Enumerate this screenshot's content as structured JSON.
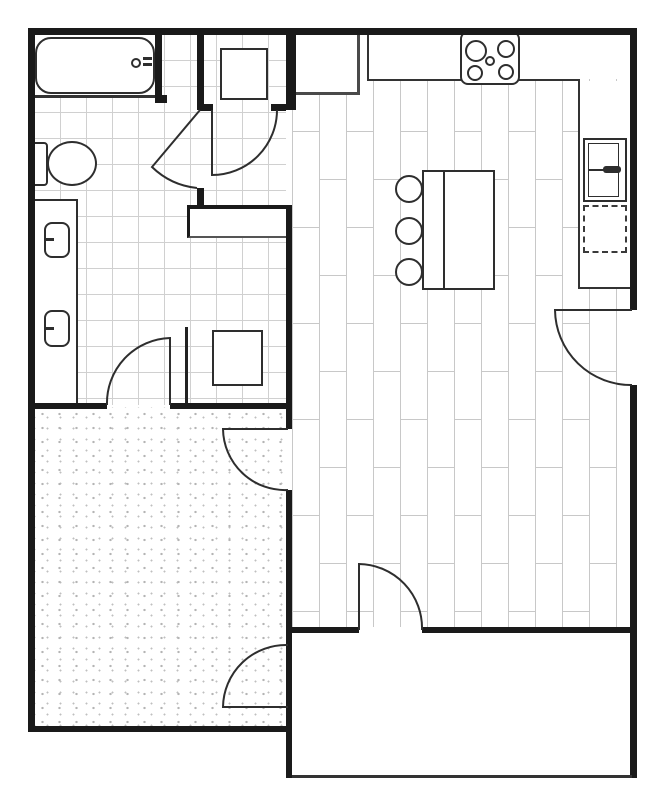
{
  "document": {
    "type": "floor-plan",
    "title": "One-bedroom apartment floor plan"
  },
  "colors": {
    "wall": "#1a1a1a",
    "line": "#333333",
    "fixture": "#2e2e2e",
    "tile_line": "#d0d0d0",
    "plank_line": "#c8c8c8",
    "carpet_dot": "#b4b4b4",
    "background": "#ffffff"
  },
  "rooms": [
    {
      "id": "bathroom",
      "label": "Bathroom with tub, toilet and double vanity",
      "floor": "tile"
    },
    {
      "id": "laundry-closet",
      "label": "Laundry closet with washer",
      "floor": "tile"
    },
    {
      "id": "hallway",
      "label": "Hallway with utility closet and niche",
      "floor": "tile"
    },
    {
      "id": "pantry",
      "label": "Pantry closet",
      "floor": "wood"
    },
    {
      "id": "kitchen-living",
      "label": "Kitchen and living room",
      "floor": "wood-plank"
    },
    {
      "id": "bedroom",
      "label": "Bedroom",
      "floor": "carpet"
    },
    {
      "id": "patio",
      "label": "Patio / entry area",
      "floor": "bare"
    }
  ],
  "fixtures": [
    {
      "id": "bathtub",
      "label": "Bathtub with faucet"
    },
    {
      "id": "toilet",
      "label": "Toilet"
    },
    {
      "id": "vanity",
      "label": "Vanity counter with two sinks"
    },
    {
      "id": "washer",
      "label": "Washer / dryer unit"
    },
    {
      "id": "utility-unit",
      "label": "Utility / water-heater closet unit"
    },
    {
      "id": "niche",
      "label": "Hall niche / linen shelf"
    },
    {
      "id": "pantry-box",
      "label": "Pantry cabinet"
    },
    {
      "id": "counter",
      "label": "L-shaped kitchen counter"
    },
    {
      "id": "cooktop",
      "label": "Cooktop with four burners"
    },
    {
      "id": "refrigerator",
      "label": "Refrigerator"
    },
    {
      "id": "dishwasher",
      "label": "Dashed appliance space (dishwasher)"
    },
    {
      "id": "island",
      "label": "Kitchen island with seating overhang"
    },
    {
      "id": "stools",
      "label": "Three bar stools"
    }
  ],
  "doors": [
    {
      "id": "bathroom-door",
      "label": "Door from hallway into bathroom"
    },
    {
      "id": "laundry-door",
      "label": "Door from hallway into laundry closet"
    },
    {
      "id": "bedroom-hall-door",
      "label": "Door from hallway into bedroom"
    },
    {
      "id": "bedroom-living-door",
      "label": "Door from living room into bedroom"
    },
    {
      "id": "bedroom-patio-door",
      "label": "Door from patio into bedroom"
    },
    {
      "id": "living-patio-door",
      "label": "Door from patio into living room"
    },
    {
      "id": "entry-door",
      "label": "Entry door in right wall"
    }
  ]
}
